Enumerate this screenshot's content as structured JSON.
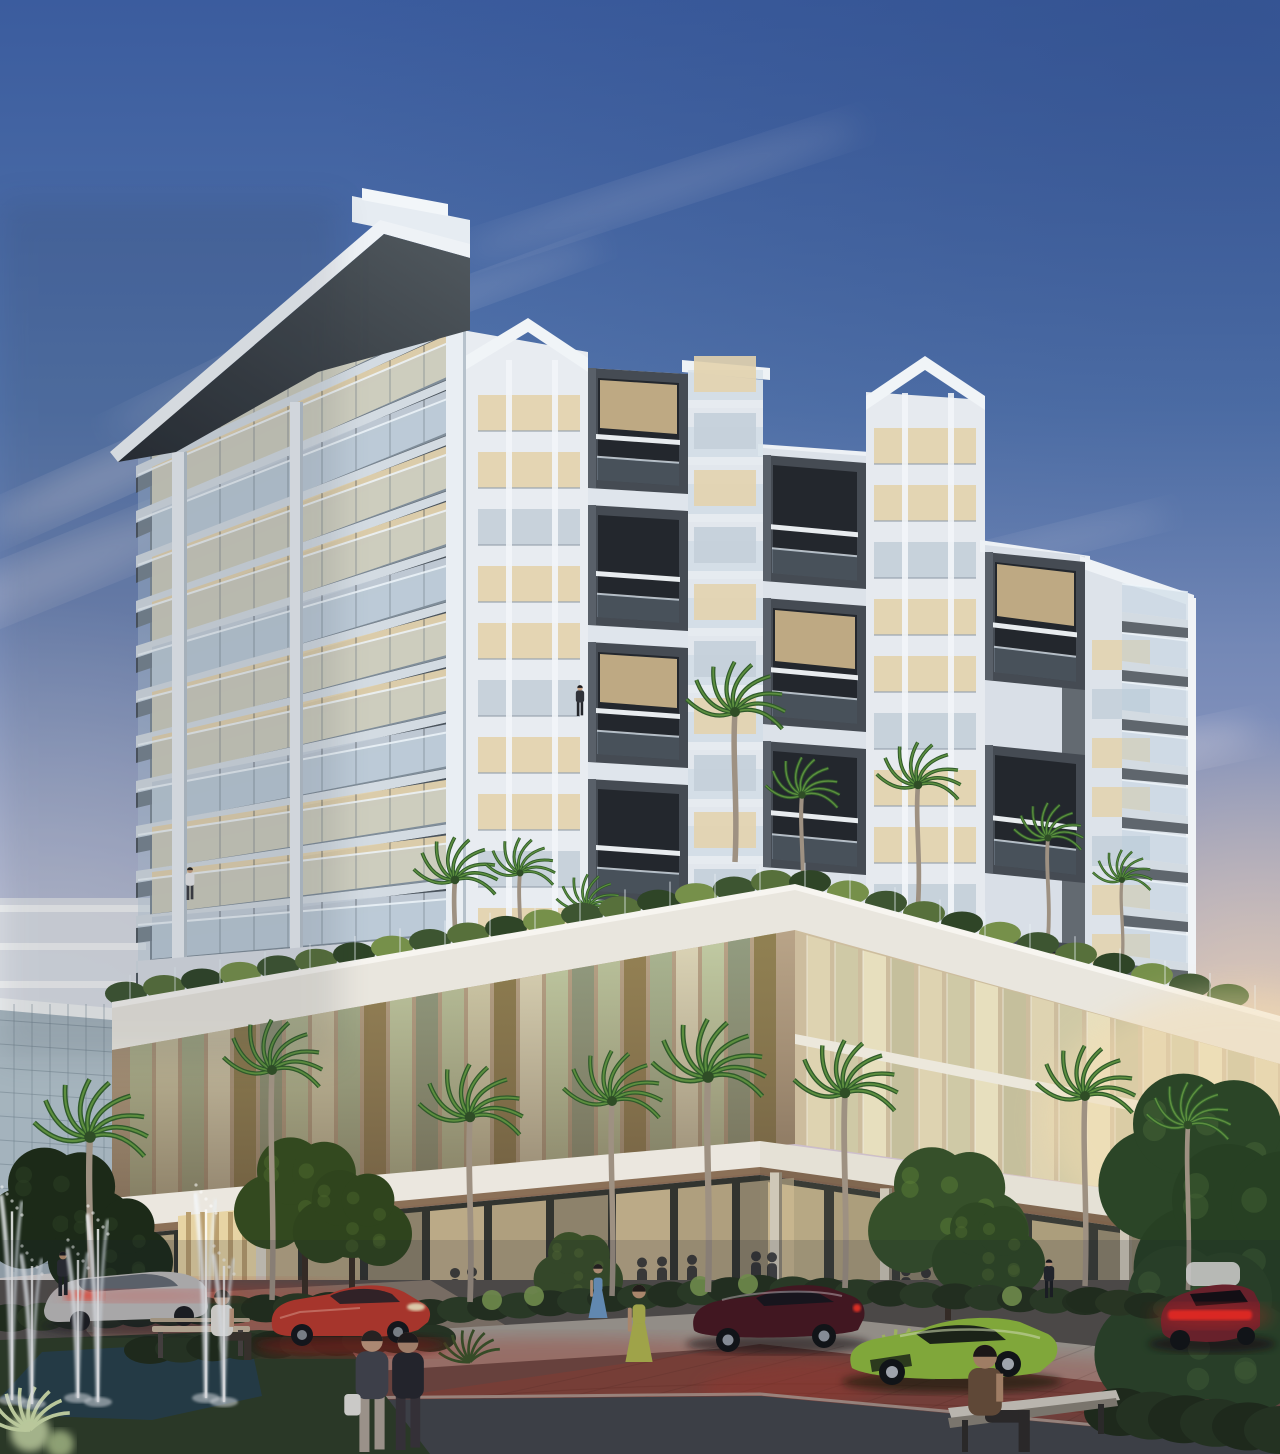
{
  "meta": {
    "type": "architectural-rendering",
    "subject": "modern-mixed-use-condo-tower",
    "time_of_day": "dusk",
    "setting": "tropical-street-corner-with-plaza"
  },
  "sky": {
    "top": "#3b5c9e",
    "upper": "#5273aa",
    "mid": "#7f8fba",
    "lavender": "#aaa8c6",
    "pink": "#cfc0cc",
    "peach": "#e9d6c2",
    "horizon": "#f0e0c8",
    "glow": "#f2d5ae"
  },
  "palette": {
    "facade_white": "#e9edf2",
    "slab_light": "#d3dbe2",
    "soffit_dark": "#4a525b",
    "frame_charcoal": "#454b53",
    "frame_inner": "#23272d",
    "glass_warm": "#e3d3ae",
    "glass_cool": "#c4cfd9",
    "rail_glass": "#b9cedd",
    "podium_stone": "#c9b69a",
    "bronze": "#8a7444",
    "canopy_white": "#ebe7df",
    "storefront_glow": "#c9b690",
    "hedge_dark": "#24321d",
    "leaf_light": "#7f9f52",
    "palm_dark": "#2f5a2a",
    "palm_light": "#5d8f3f",
    "trunk": "#9e9182",
    "lawn": "#2e3d26",
    "pool": "#274049",
    "water_white": "#f4f8fa",
    "sidewalk": "#aaa298",
    "brick": "#6e4a42",
    "brick_glow": "#b83a2c",
    "asphalt": "#43464a",
    "red_glow": "#d0402e"
  },
  "street": {
    "cars": [
      {
        "name": "silver-sedan",
        "color": "#c4c1bf"
      },
      {
        "name": "red-sports-car",
        "color": "#c23a2b"
      },
      {
        "name": "dark-red-coupe",
        "color": "#49161e"
      },
      {
        "name": "green-supercar",
        "color": "#94c23c"
      },
      {
        "name": "maroon-sports-car",
        "color": "#78222a"
      },
      {
        "name": "white-car",
        "color": "#e9e7e2"
      }
    ],
    "furniture": [
      "park-bench-left",
      "park-bench-right"
    ],
    "water_features": [
      "fountain-jets",
      "reflecting-pool"
    ],
    "paving": [
      "granite-sidewalk",
      "red-brick-pavers",
      "dark-asphalt"
    ]
  },
  "street_people": [
    {
      "name": "woman-white-bag",
      "x": 372,
      "foot": 1452,
      "h": 126,
      "kind": "walk",
      "top": "#45464e",
      "bottom": "#b3a79a",
      "hair": "#2a2320",
      "skin": "#c79d7f",
      "bag": "#eceae4"
    },
    {
      "name": "woman-dark",
      "x": 408,
      "foot": 1450,
      "h": 122,
      "kind": "walk",
      "top": "#26262b",
      "bottom": "#3a3438",
      "hair": "#1f1a18",
      "skin": "#b98f74"
    },
    {
      "name": "woman-green-dress",
      "x": 639,
      "foot": 1362,
      "h": 80,
      "kind": "dress",
      "dress": "#b9bd4e",
      "hair": "#231c16",
      "skin": "#c59a78"
    },
    {
      "name": "woman-blue-dress",
      "x": 598,
      "foot": 1318,
      "h": 56,
      "kind": "dress",
      "dress": "#6f9cc9",
      "hair": "#23201c",
      "skin": "#c8a080"
    },
    {
      "name": "man-entrance",
      "x": 1049,
      "foot": 1298,
      "h": 40,
      "kind": "walk",
      "top": "#23252a",
      "bottom": "#1b1d21",
      "hair": "#15161a",
      "skin": "#caa184"
    },
    {
      "name": "walker-left",
      "x": 63,
      "foot": 1296,
      "h": 46,
      "kind": "walk",
      "top": "#2a2c31",
      "bottom": "#202227",
      "hair": "#17181c",
      "skin": "#b8906e"
    },
    {
      "name": "girl-on-bench",
      "x": 222,
      "foot": 1360,
      "h": 92,
      "kind": "sit",
      "top": "#eae6de",
      "bottom": "#3c342c",
      "hair": "#2b2016",
      "skin": "#c79d7f"
    },
    {
      "name": "man-on-bench",
      "x": 985,
      "foot": 1452,
      "h": 140,
      "kind": "sit",
      "top": "#6d5038",
      "bottom": "#2e2a28",
      "hair": "#1d1612",
      "skin": "#b98f6e"
    },
    {
      "name": "balcony-person-1",
      "x": 190,
      "foot": 900,
      "h": 34,
      "kind": "walk",
      "top": "#e8e8ea",
      "bottom": "#3a3c42",
      "hair": "#222222",
      "skin": "#c9a183"
    },
    {
      "name": "balcony-person-2",
      "x": 580,
      "foot": 716,
      "h": 32,
      "kind": "walk",
      "top": "#30333a",
      "bottom": "#24262b",
      "hair": "#1a1b1f",
      "skin": "#c9a183"
    }
  ],
  "geometry": {
    "left_tower": {
      "x1": 138,
      "x2": 462,
      "right_y0": 318,
      "dy": 56,
      "slope0": 148,
      "slope_step": 11,
      "floors": 12,
      "rail_h": 36,
      "win_off": 44,
      "columns": [
        {
          "x": 172,
          "w": 15,
          "top": 452
        },
        {
          "x": 290,
          "w": 13,
          "top": 402
        },
        {
          "x": 446,
          "w": 20,
          "top": 330
        }
      ]
    },
    "right_wing": {
      "slab_x1": 1122,
      "slab_x2": 1188,
      "y0": 612,
      "dy": 49,
      "count": 8,
      "drop": 8
    },
    "wing_windows": {
      "x": 1092,
      "w": 58,
      "y0": 640,
      "dy": 49,
      "count": 8
    },
    "box_columns": [
      {
        "x": 588,
        "w": 100,
        "drop": 6,
        "h": 120,
        "rows": [
          368,
          505,
          642,
          779
        ]
      },
      {
        "x": 763,
        "w": 103,
        "drop": 8,
        "h": 126,
        "rows": [
          455,
          598,
          741
        ]
      },
      {
        "x": 985,
        "w": 100,
        "drop": 10,
        "h": 128,
        "rows": [
          552,
          745,
          935
        ]
      }
    ],
    "bay_windows": [
      {
        "x": 470,
        "w": 102,
        "y0": 395,
        "dy": 57,
        "count": 10,
        "strips": [
          506,
          552
        ]
      },
      {
        "x": 688,
        "w": 75,
        "y0": 400,
        "dy": 57,
        "count": 10,
        "slab": true
      },
      {
        "x": 866,
        "w": 102,
        "y0": 428,
        "dy": 57,
        "count": 9,
        "strips": [
          902,
          948
        ]
      }
    ],
    "parapet": {
      "lx": 112,
      "ly": 1004,
      "cx": 795,
      "cy": 886,
      "rx": 1280,
      "ry": 1018,
      "band": 46
    },
    "podium_left": {
      "x1": 112,
      "x2": 795,
      "top1": 1050,
      "top2": 930,
      "bot1": 1198,
      "bot2": 1144,
      "step": 26
    },
    "podium_right": {
      "x1": 795,
      "x2": 1280,
      "top1": 932,
      "top2": 1064,
      "bot1": 1144,
      "bot2": 1212,
      "step": 28
    },
    "canopy_corner_x": 760,
    "street_palms": [
      {
        "x": 90,
        "base": 1332,
        "h": 195,
        "s": 1.15
      },
      {
        "x": 272,
        "base": 1300,
        "h": 230,
        "s": 1.0
      },
      {
        "x": 470,
        "base": 1302,
        "h": 185,
        "s": 1.05
      },
      {
        "x": 612,
        "base": 1296,
        "h": 195,
        "s": 1.0
      },
      {
        "x": 708,
        "base": 1292,
        "h": 215,
        "s": 1.15
      },
      {
        "x": 845,
        "base": 1288,
        "h": 195,
        "s": 1.05
      },
      {
        "x": 1085,
        "base": 1286,
        "h": 190,
        "s": 1.0
      },
      {
        "x": 1188,
        "base": 1290,
        "h": 165,
        "s": 0.85
      }
    ],
    "deck_palms": [
      {
        "x": 455,
        "base": 985,
        "h": 105,
        "s": 0.85
      },
      {
        "x": 520,
        "base": 968,
        "h": 95,
        "s": 0.7
      },
      {
        "x": 588,
        "base": 992,
        "h": 85,
        "s": 0.65
      },
      {
        "x": 735,
        "base": 862,
        "h": 150,
        "s": 1.0
      },
      {
        "x": 802,
        "base": 905,
        "h": 110,
        "s": 0.75
      },
      {
        "x": 918,
        "base": 905,
        "h": 120,
        "s": 0.85
      },
      {
        "x": 1048,
        "base": 938,
        "h": 100,
        "s": 0.7
      },
      {
        "x": 1122,
        "base": 965,
        "h": 85,
        "s": 0.6
      }
    ],
    "jets": [
      {
        "x": 12,
        "base": 1400,
        "h": 205
      },
      {
        "x": 32,
        "base": 1404,
        "h": 150
      },
      {
        "x": 78,
        "base": 1398,
        "h": 150
      },
      {
        "x": 98,
        "base": 1402,
        "h": 188
      },
      {
        "x": 206,
        "base": 1398,
        "h": 205
      },
      {
        "x": 224,
        "base": 1402,
        "h": 148
      }
    ],
    "interior_people_x": [
      150,
      178,
      455,
      472,
      642,
      662,
      692,
      756,
      772,
      906,
      926,
      1098,
      1252
    ],
    "clouds": [
      [
        120,
        470,
        280,
        44,
        -24,
        0.3
      ],
      [
        60,
        570,
        320,
        54,
        -22,
        0.25
      ],
      [
        210,
        380,
        220,
        30,
        -26,
        0.2
      ],
      [
        660,
        190,
        420,
        38,
        -18,
        0.15
      ],
      [
        450,
        300,
        320,
        30,
        -20,
        0.18
      ],
      [
        950,
        660,
        300,
        46,
        -16,
        0.22
      ],
      [
        1120,
        760,
        280,
        44,
        -12,
        0.28
      ],
      [
        1060,
        540,
        220,
        30,
        -14,
        0.15
      ]
    ]
  }
}
